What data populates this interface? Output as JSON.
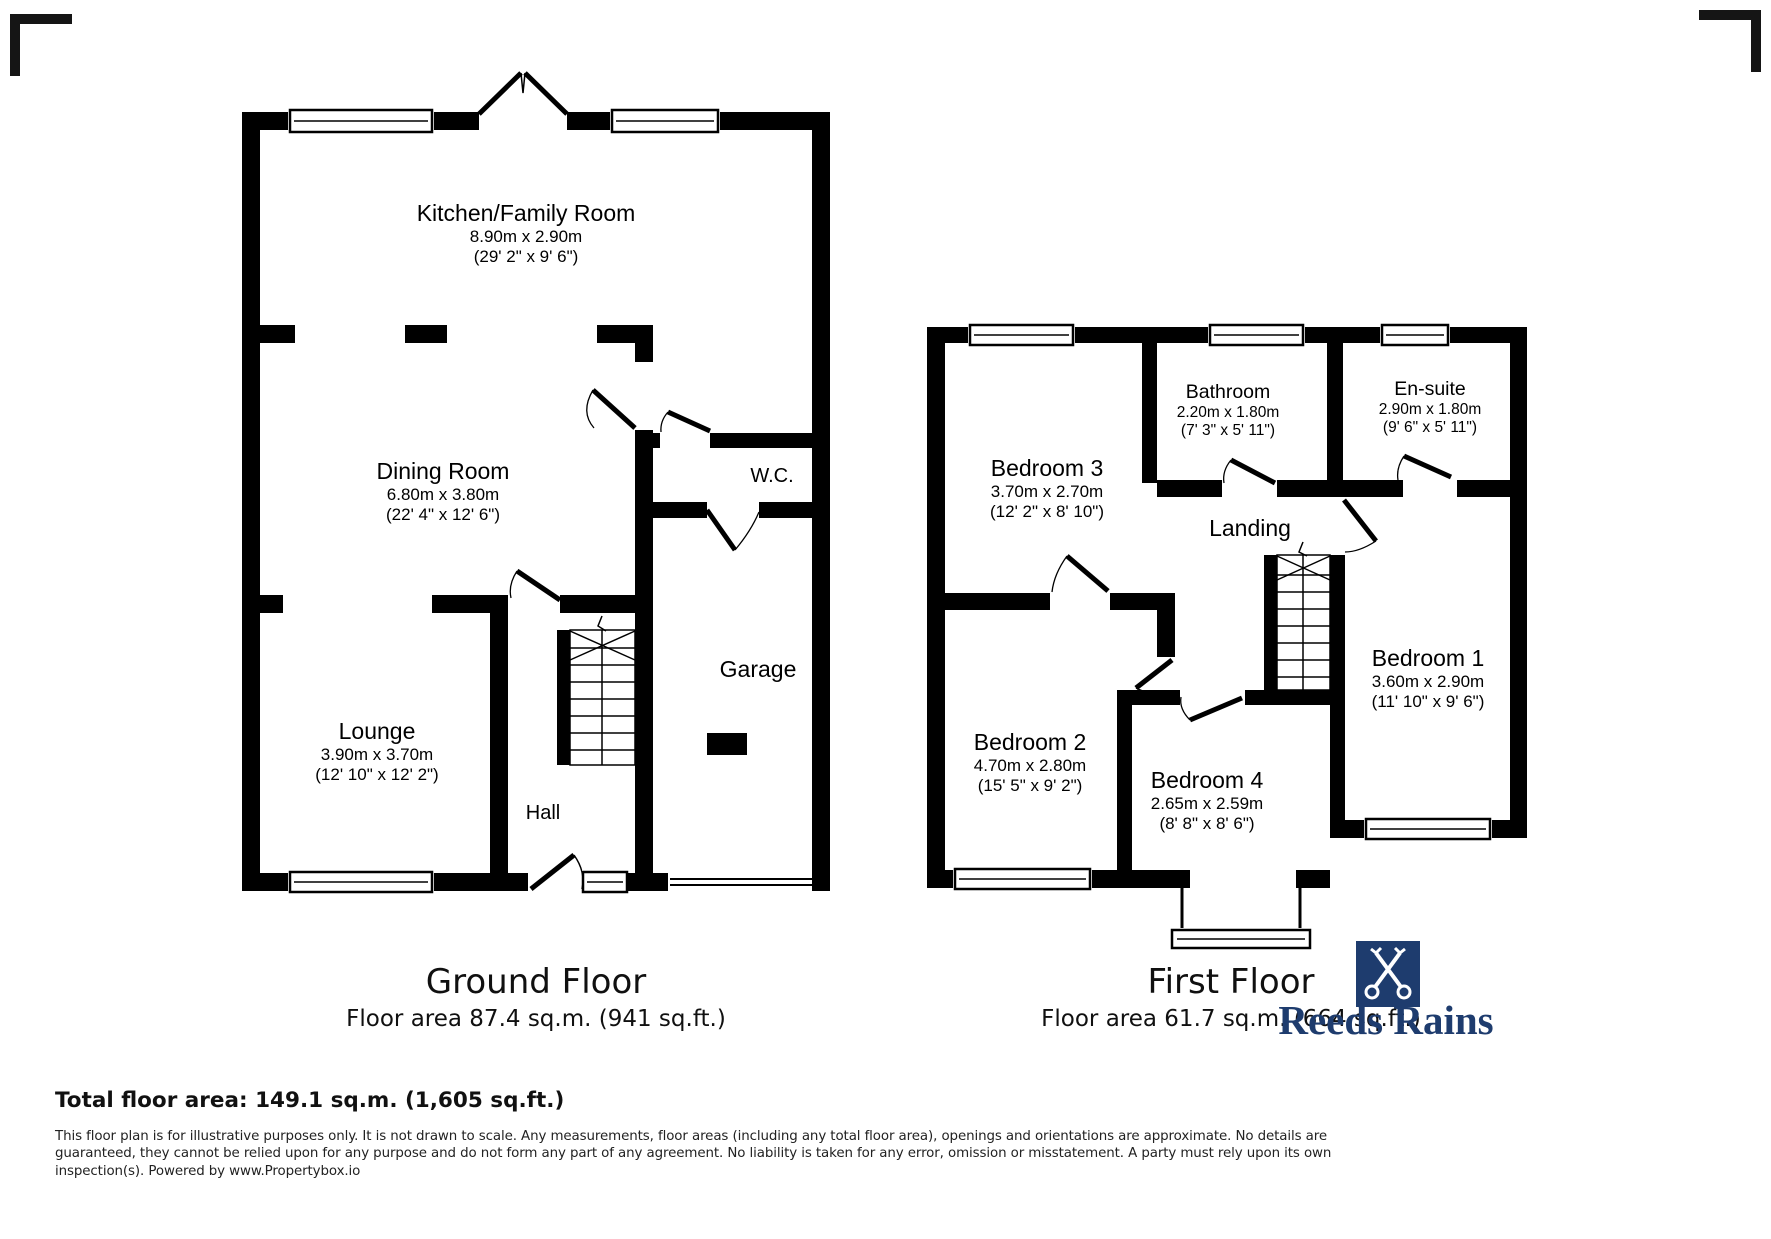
{
  "floors": {
    "ground": {
      "title": "Ground Floor",
      "area_line": "Floor area 87.4 sq.m. (941 sq.ft.)",
      "rooms": [
        {
          "name": "Kitchen/Family Room",
          "metric": "8.90m x 2.90m",
          "imperial": "(29' 2\" x 9' 6\")"
        },
        {
          "name": "Dining Room",
          "metric": "6.80m x 3.80m",
          "imperial": "(22' 4\" x 12' 6\")"
        },
        {
          "name": "W.C."
        },
        {
          "name": "Lounge",
          "metric": "3.90m x 3.70m",
          "imperial": "(12' 10\" x 12' 2\")"
        },
        {
          "name": "Hall"
        },
        {
          "name": "Garage"
        }
      ]
    },
    "first": {
      "title": "First Floor",
      "area_line": "Floor area 61.7 sq.m. (664 sq.ft.)",
      "rooms": [
        {
          "name": "Bedroom 3",
          "metric": "3.70m x 2.70m",
          "imperial": "(12' 2\" x 8' 10\")"
        },
        {
          "name": "Bathroom",
          "metric": "2.20m x 1.80m",
          "imperial": "(7' 3\" x 5' 11\")"
        },
        {
          "name": "En-suite",
          "metric": "2.90m x 1.80m",
          "imperial": "(9' 6\" x 5' 11\")"
        },
        {
          "name": "Landing"
        },
        {
          "name": "Bedroom 1",
          "metric": "3.60m x 2.90m",
          "imperial": "(11' 10\" x 9' 6\")"
        },
        {
          "name": "Bedroom 2",
          "metric": "4.70m x 2.80m",
          "imperial": "(15' 5\" x 9' 2\")"
        },
        {
          "name": "Bedroom 4",
          "metric": "2.65m x 2.59m",
          "imperial": "(8' 8\" x 8' 6\")"
        }
      ]
    }
  },
  "footer": {
    "total": "Total floor area: 149.1 sq.m. (1,605 sq.ft.)",
    "disclaimer": "This floor plan is for illustrative purposes only. It is not drawn to scale. Any measurements, floor areas (including any total floor area), openings and orientations are approximate. No details are guaranteed, they cannot be relied upon for any purpose and do not form any part of any agreement. No liability is taken for any error, omission or misstatement. A party must rely upon its own inspection(s). Powered by www.Propertybox.io"
  },
  "brand": {
    "name": "Reeds Rains",
    "color": "#1e3c6e",
    "icon": "crossed-keys-icon"
  }
}
